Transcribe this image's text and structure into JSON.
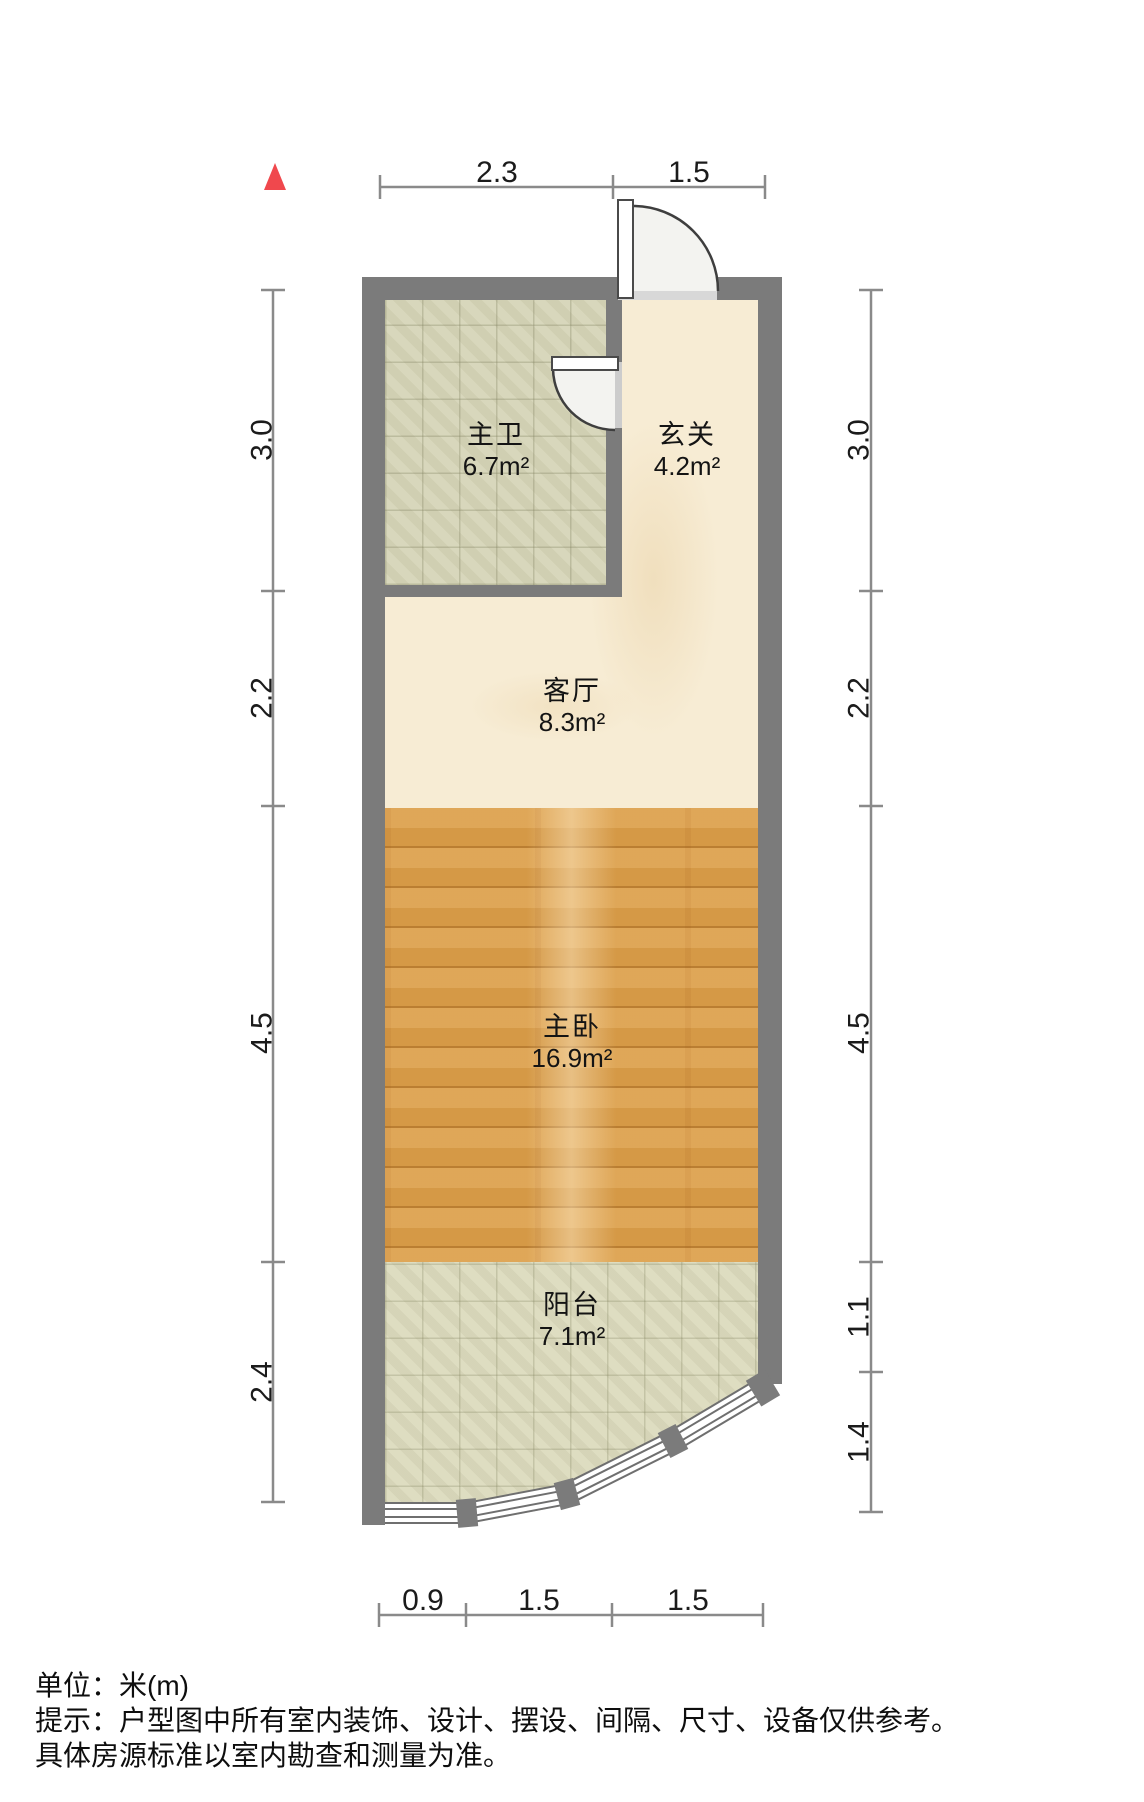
{
  "rooms": [
    {
      "id": "bathroom",
      "name": "主卫",
      "area": "6.7m²"
    },
    {
      "id": "foyer",
      "name": "玄关",
      "area": "4.2m²"
    },
    {
      "id": "living",
      "name": "客厅",
      "area": "8.3m²"
    },
    {
      "id": "bedroom",
      "name": "主卧",
      "area": "16.9m²"
    },
    {
      "id": "balcony",
      "name": "阳台",
      "area": "7.1m²"
    }
  ],
  "dimensions": {
    "top": [
      "2.3",
      "1.5"
    ],
    "bottom": [
      "0.9",
      "1.5",
      "1.5"
    ],
    "left": [
      "3.0",
      "2.2",
      "4.5",
      "2.4"
    ],
    "right": [
      "3.0",
      "2.2",
      "4.5",
      "1.1",
      "1.4"
    ]
  },
  "footer": {
    "line1": "单位：米(m)",
    "line2": "提示：户型图中所有室内装饰、设计、摆设、间隔、尺寸、设备仅供参考。",
    "line3": "具体房源标准以室内勘查和测量为准。"
  },
  "icons": {
    "north": "north-arrow-icon"
  },
  "colors": {
    "wall": "#7b7b7b",
    "door_opening": "#d8d8d8",
    "bathroom_opening": "#cccccc",
    "bathroom_floor": "#d6d5b8",
    "balcony_floor": "#dcdbbe",
    "marble_floor": "#f7ecd4",
    "wood_floor": "#dda04b",
    "window_frame": "#6f6f6f",
    "dimension_line": "#8a8a8a",
    "text": "#1b1b1b",
    "north": "#f0484d"
  }
}
